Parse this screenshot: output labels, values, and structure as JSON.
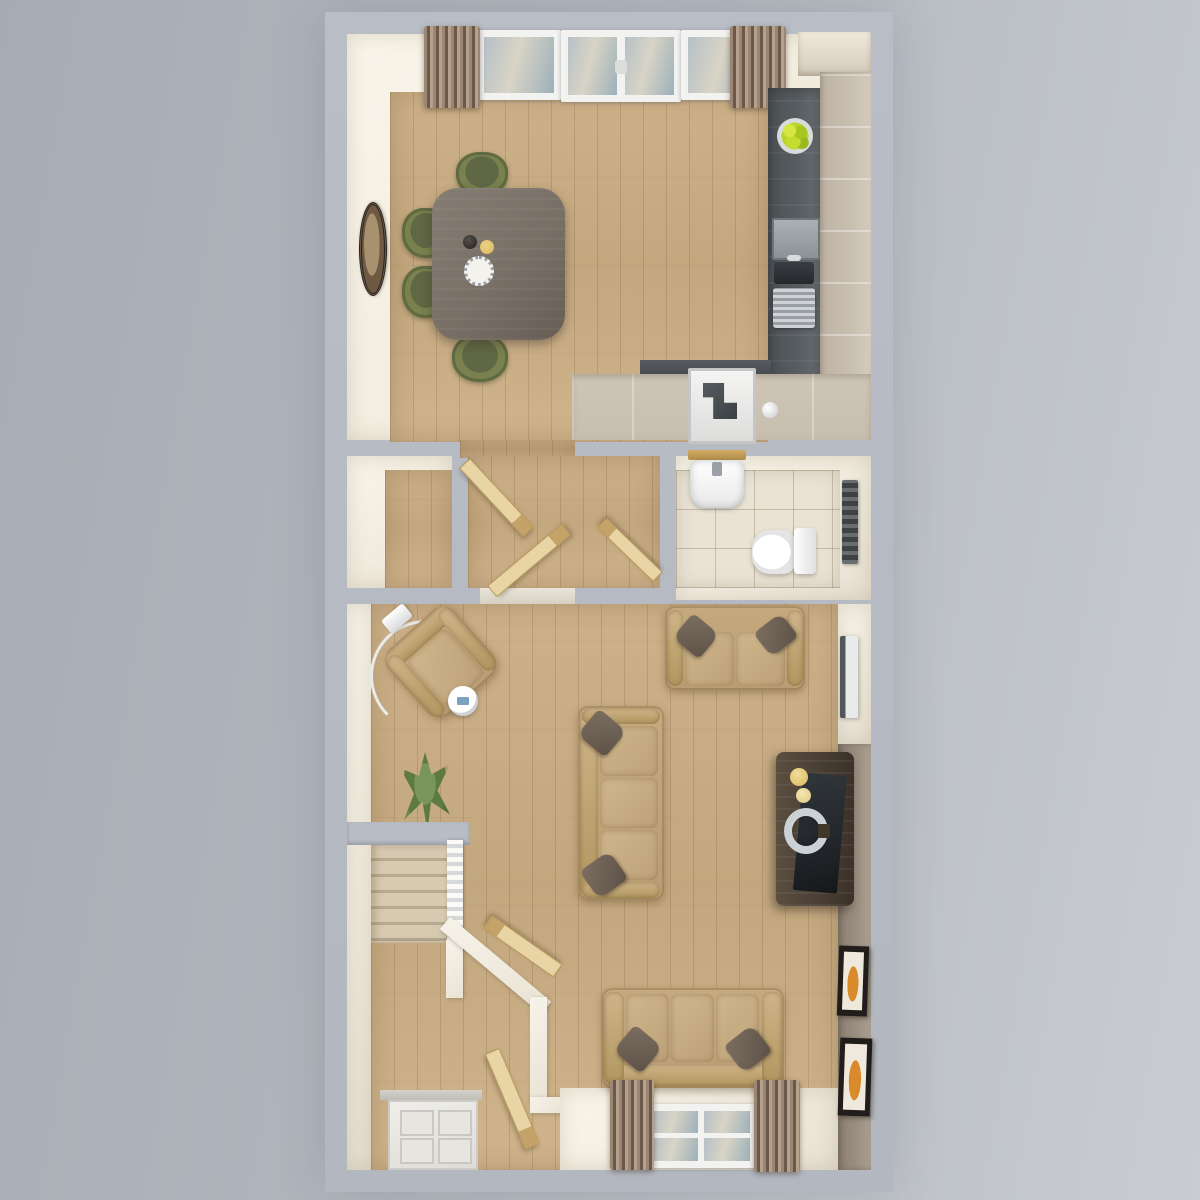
{
  "scene": {
    "kind": "3d-floorplan-render",
    "view": "top-down",
    "floor": "ground floor",
    "text_on_image": ""
  },
  "palette": {
    "bg_left": "#a7acb4",
    "bg_right": "#c9cdd2",
    "wall_cut": "#b9bec6",
    "wall_face": "#f1ebde",
    "wall_face_bright": "#faf5ea",
    "floor_wood": "#cdb189",
    "tile": "#eae3d4",
    "tile_line": "rgba(150,140,112,0.45)",
    "carpet": "#d8cab1",
    "carpet_dark": "#b7a98f",
    "sofa": "#c6aa7f",
    "sofa_cushion": "#d0b68c",
    "pillow": "#7c6e61",
    "chair_olive": "#79814f",
    "chair_olive_dark": "#5f6744",
    "table_wood": "#796f66",
    "counter_dark": "#585d61",
    "cabinet": "#c8beaf",
    "curtain_a": "#9b8673",
    "curtain_b": "#6b584a",
    "door_wood": "#e8d4a4",
    "door_wood_edge": "#c4a268",
    "accent_wall": "#9c9082",
    "media_unit": "#4a3f34",
    "tv": "#22262a",
    "glass": "#b6c0c7",
    "white_fixture": "#f2f2f0",
    "radiator": "#e9eaea",
    "frame_dark": "#201d1a",
    "art_orange": "#d98a2b",
    "plant_green": "#5e7a43",
    "fruit_green": "#b8d42e",
    "gold": "#d9b85a"
  },
  "rooms": [
    {
      "name": "kitchen-dining",
      "furniture": [
        "patio-doors",
        "window-pair",
        "curtains",
        "dining-table",
        "six-olive-chairs",
        "wall-mirror",
        "l-shaped-kitchen-counter",
        "sink-and-hob",
        "fruit-bowl",
        "oven",
        "tall-cabinet"
      ]
    },
    {
      "name": "hallway",
      "furniture": [
        "three-open-doors"
      ]
    },
    {
      "name": "storage-cupboard",
      "furniture": []
    },
    {
      "name": "wc",
      "furniture": [
        "basin",
        "wood-shelf",
        "toilet",
        "towel-radiator"
      ]
    },
    {
      "name": "living-room",
      "furniture": [
        "armchair",
        "arc-floor-lamp",
        "side-table",
        "loveseat",
        "three-seat-sofa-center",
        "three-seat-sofa-window",
        "media-console-tv",
        "radiator",
        "plant",
        "two-picture-frames",
        "window-with-curtains"
      ]
    },
    {
      "name": "entrance-hall",
      "furniture": [
        "front-door",
        "staircase",
        "two-open-doors"
      ]
    }
  ]
}
